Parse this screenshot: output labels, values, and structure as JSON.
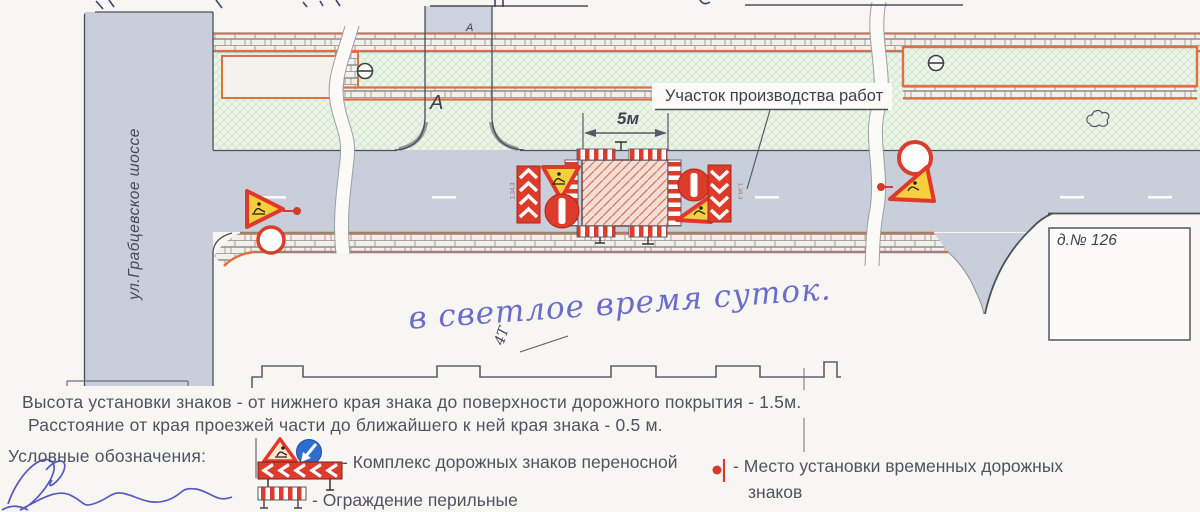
{
  "scheme": {
    "street_label": "ул.Грабцевское шоссе",
    "driveway_label": "А",
    "top_access_label": "А",
    "work_area_label": "Участок производства работ",
    "work_zone_width_label": "5м",
    "building_label": "д.№ 126",
    "sign_code_left": "1.34.3",
    "sign_code_right": "1.34.3",
    "handwritten_note": "в светлое время суток.",
    "handwritten_mark": "4Т"
  },
  "notes": {
    "line1": "Высота установки знаков -  от нижнего края знака до поверхности дорожного покрытия - 1.5м.",
    "line2": "Расстояние от края проезжей части до ближайшего к ней края знака - 0.5 м."
  },
  "legend": {
    "title": "Условные обозначения:",
    "sign_complex_label": "- Комплекс дорожных знаков переносной",
    "temp_signs_label_line1": "- Место установки временных дорожных",
    "temp_signs_label_line2": "знаков",
    "railing_label": "- Ограждение перильные"
  },
  "icons": {
    "road_works_sign": "warning-triangle-roadworks",
    "detour_direction_sign": "blue-circle-arrow",
    "chevron_panel": "red-white-chevron-board",
    "no_entry_sign": "red-circle-white-bar",
    "empty_round_sign": "white-circle-red-ring",
    "temp_sign_marker": "red-dot-with-post",
    "utility_symbol": "Θ",
    "tree_symbol": "bush-outline"
  },
  "colors": {
    "road": "#c9cedb",
    "lawn": "#eaf4e7",
    "work_zone_fill": "#f6ddd3",
    "sign_red": "#dd3b2c",
    "sign_blue": "#2f6cd0",
    "accent_orange": "#e07040",
    "ink_blue": "#5b5fc0",
    "line_dark": "#4a4f58"
  }
}
